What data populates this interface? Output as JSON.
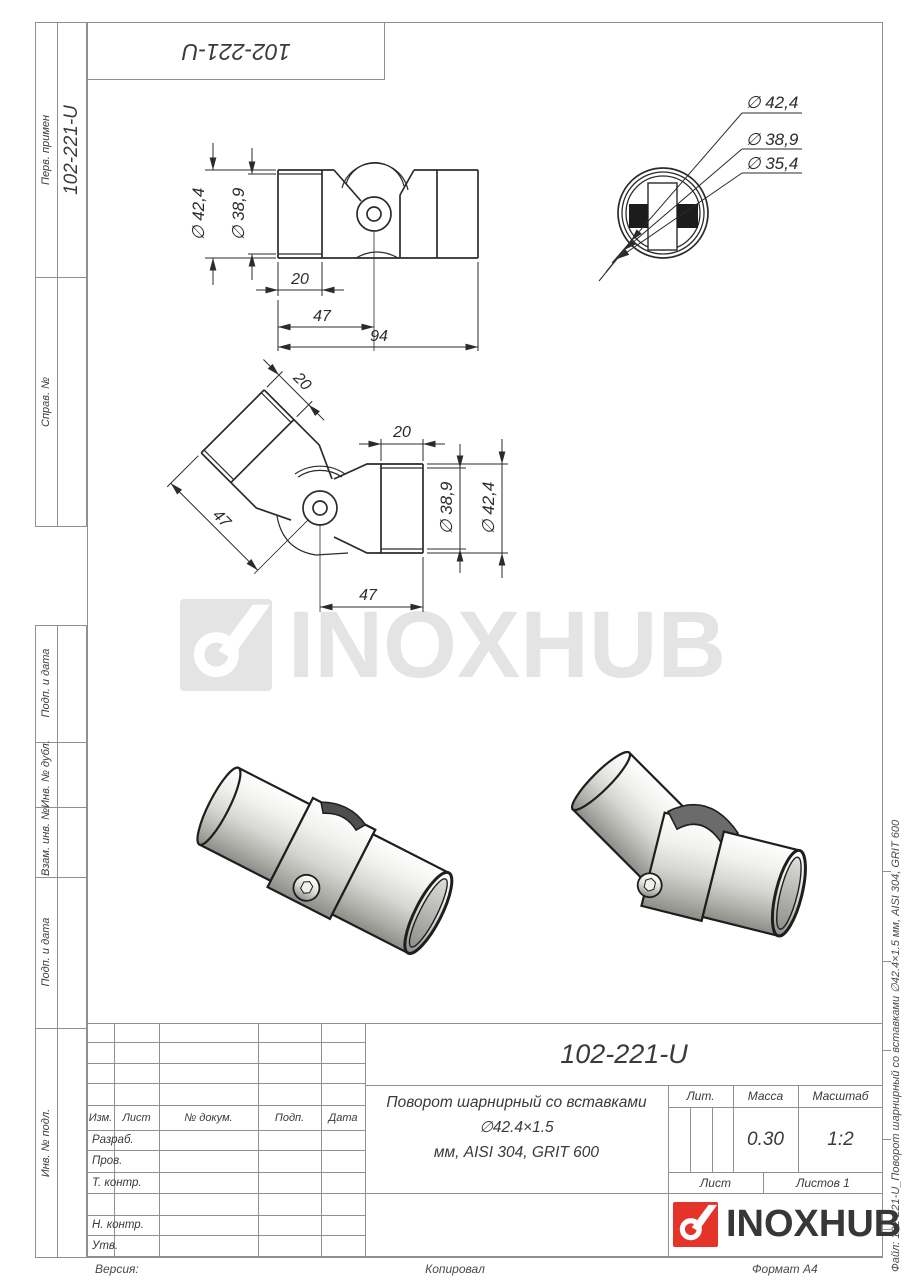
{
  "page": {
    "designation": "102-221-U",
    "format_note": "Формат А4"
  },
  "top_stamp": {
    "text": "102-221-U"
  },
  "sidebar": {
    "upper_sections": [
      {
        "label": "Перв. примен",
        "value": "102-221-U"
      },
      {
        "label": "Справ. №",
        "value": ""
      }
    ],
    "lower_sections": [
      {
        "label": "Подп. и дата"
      },
      {
        "label": "Инв. № дубл."
      },
      {
        "label": "Взам. инв. №"
      },
      {
        "label": "Подп. и дата"
      },
      {
        "label": "Инв. № подл."
      }
    ]
  },
  "drawing": {
    "front_view": {
      "dia_outer": "∅ 42,4",
      "dia_inner": "∅ 38,9",
      "dim_insert": "20",
      "dim_half": "47",
      "dim_total": "94"
    },
    "angled_view": {
      "dim_insert_left": "20",
      "dim_insert_right": "20",
      "dim_len_left": "47",
      "dim_len_right": "47",
      "dia_inner": "∅ 38,9",
      "dia_outer": "∅ 42,4"
    },
    "end_view": {
      "dia_1": "∅ 42,4",
      "dia_2": "∅ 38,9",
      "dia_3": "∅ 35,4"
    }
  },
  "watermark": {
    "brand": "INOXHUB"
  },
  "title_block": {
    "revision_headers": [
      "Изм.",
      "Лист",
      "№ докум.",
      "Подп.",
      "Дата"
    ],
    "staff_rows": [
      "Разраб.",
      "Пров.",
      "Т. контр.",
      "",
      "Н. контр.",
      "Утв."
    ],
    "designation": "102-221-U",
    "description_line1": "Поворот шарнирный со вставками ∅42.4×1.5",
    "description_line2": "мм, AISI 304, GRIT 600",
    "lit_label": "Лит.",
    "mass_label": "Масса",
    "mass_value": "0.30",
    "scale_label": "Масштаб",
    "scale_value": "1:2",
    "sheet_label": "Лист",
    "sheets_label": "Листов 1",
    "logo_text": "INOXHUB"
  },
  "margins": {
    "bottom_left": "Версия:",
    "bottom_center": "Копировал",
    "bottom_right": "Формат А4",
    "file_note": "Файл: 102-221-U_Поворот шарнирный со вставками ∅42.4×1.5 мм, AISI 304, GRIT 600"
  },
  "colors": {
    "line_dark": "#2b2b2b",
    "line_grid": "#909090",
    "logo_red": "#e63329",
    "logo_dark": "#37373a",
    "watermark_gray": "#e4e4e4"
  }
}
